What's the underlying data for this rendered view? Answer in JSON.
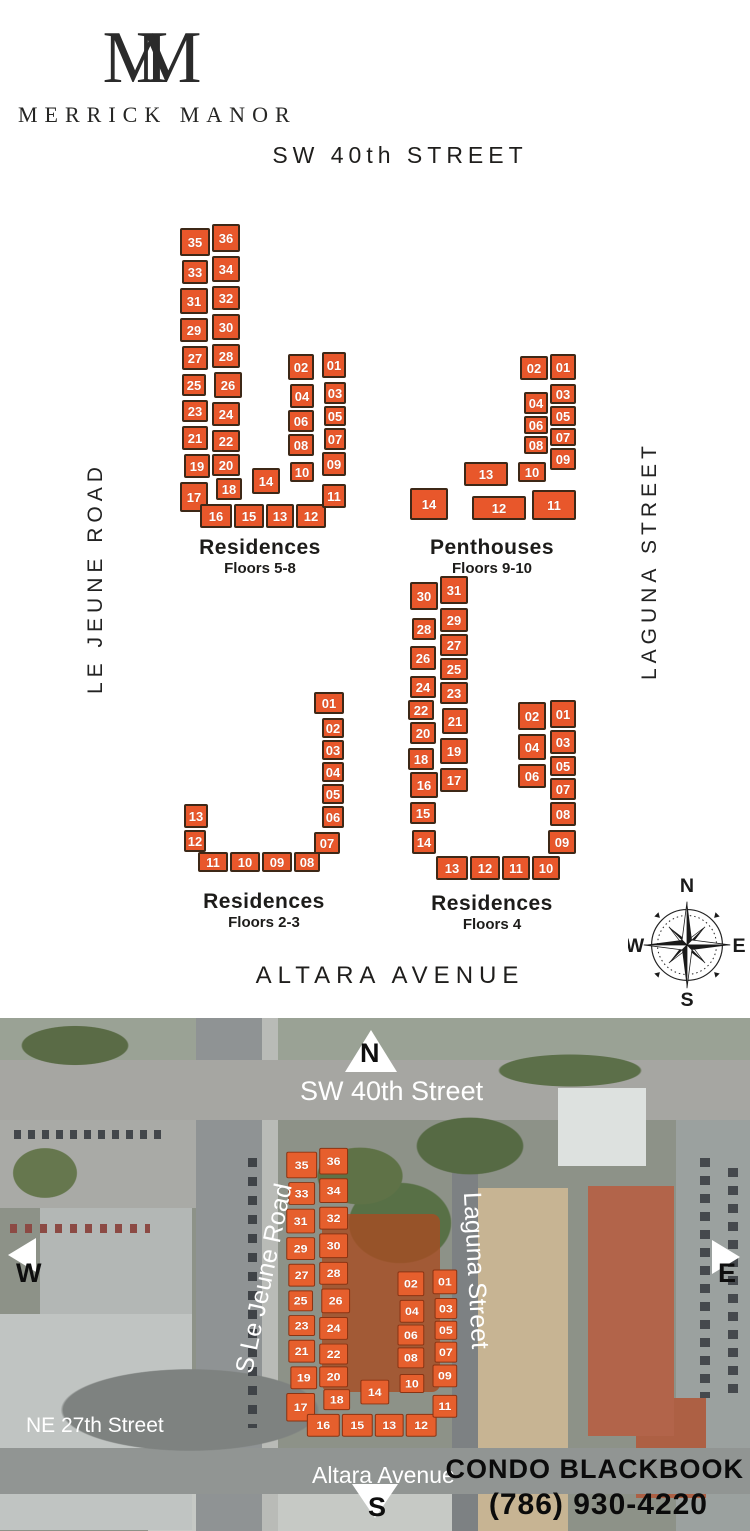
{
  "brand": {
    "monogram_left": "M",
    "monogram_right": "M",
    "name": "MERRICK MANOR"
  },
  "streets": {
    "top": "SW 40th STREET",
    "left": "LE JEUNE ROAD",
    "right": "LAGUNA STREET",
    "bottom": "ALTARA AVENUE"
  },
  "colors": {
    "unit": "#e8572b",
    "unit_border": "#3d2817",
    "overlay_unit": "#e65f2d"
  },
  "compass": {
    "n": "N",
    "e": "E",
    "s": "S",
    "w": "W"
  },
  "buildings": [
    {
      "id": "residences-5-8",
      "title": "Residences",
      "subtitle": "Floors 5-8",
      "pos": {
        "left": 172,
        "top": 222,
        "width": 176,
        "height": 308
      },
      "label_dy": 6,
      "units": [
        {
          "n": "35",
          "x": 8,
          "y": 6,
          "w": 30,
          "h": 28
        },
        {
          "n": "36",
          "x": 40,
          "y": 2,
          "w": 28,
          "h": 28
        },
        {
          "n": "33",
          "x": 10,
          "y": 38,
          "w": 26,
          "h": 24
        },
        {
          "n": "34",
          "x": 40,
          "y": 34,
          "w": 28,
          "h": 26
        },
        {
          "n": "31",
          "x": 8,
          "y": 66,
          "w": 28,
          "h": 26
        },
        {
          "n": "32",
          "x": 40,
          "y": 64,
          "w": 28,
          "h": 24
        },
        {
          "n": "29",
          "x": 8,
          "y": 96,
          "w": 28,
          "h": 24
        },
        {
          "n": "30",
          "x": 40,
          "y": 92,
          "w": 28,
          "h": 26
        },
        {
          "n": "27",
          "x": 10,
          "y": 124,
          "w": 26,
          "h": 24
        },
        {
          "n": "28",
          "x": 40,
          "y": 122,
          "w": 28,
          "h": 24
        },
        {
          "n": "25",
          "x": 10,
          "y": 152,
          "w": 24,
          "h": 22
        },
        {
          "n": "26",
          "x": 42,
          "y": 150,
          "w": 28,
          "h": 26
        },
        {
          "n": "23",
          "x": 10,
          "y": 178,
          "w": 26,
          "h": 22
        },
        {
          "n": "24",
          "x": 40,
          "y": 180,
          "w": 28,
          "h": 24
        },
        {
          "n": "21",
          "x": 10,
          "y": 204,
          "w": 26,
          "h": 24
        },
        {
          "n": "22",
          "x": 40,
          "y": 208,
          "w": 28,
          "h": 22
        },
        {
          "n": "19",
          "x": 12,
          "y": 232,
          "w": 26,
          "h": 24
        },
        {
          "n": "20",
          "x": 40,
          "y": 232,
          "w": 28,
          "h": 22
        },
        {
          "n": "17",
          "x": 8,
          "y": 260,
          "w": 28,
          "h": 30
        },
        {
          "n": "18",
          "x": 44,
          "y": 256,
          "w": 26,
          "h": 22
        },
        {
          "n": "14",
          "x": 80,
          "y": 246,
          "w": 28,
          "h": 26
        },
        {
          "n": "16",
          "x": 28,
          "y": 282,
          "w": 32,
          "h": 24
        },
        {
          "n": "15",
          "x": 62,
          "y": 282,
          "w": 30,
          "h": 24
        },
        {
          "n": "13",
          "x": 94,
          "y": 282,
          "w": 28,
          "h": 24
        },
        {
          "n": "12",
          "x": 124,
          "y": 282,
          "w": 30,
          "h": 24
        },
        {
          "n": "11",
          "x": 150,
          "y": 262,
          "w": 24,
          "h": 24
        },
        {
          "n": "10",
          "x": 118,
          "y": 240,
          "w": 24,
          "h": 20
        },
        {
          "n": "02",
          "x": 116,
          "y": 132,
          "w": 26,
          "h": 26
        },
        {
          "n": "01",
          "x": 150,
          "y": 130,
          "w": 24,
          "h": 26
        },
        {
          "n": "04",
          "x": 118,
          "y": 162,
          "w": 24,
          "h": 24
        },
        {
          "n": "03",
          "x": 152,
          "y": 160,
          "w": 22,
          "h": 22
        },
        {
          "n": "06",
          "x": 116,
          "y": 188,
          "w": 26,
          "h": 22
        },
        {
          "n": "05",
          "x": 152,
          "y": 184,
          "w": 22,
          "h": 20
        },
        {
          "n": "08",
          "x": 116,
          "y": 212,
          "w": 26,
          "h": 22
        },
        {
          "n": "07",
          "x": 152,
          "y": 206,
          "w": 22,
          "h": 22
        },
        {
          "n": "09",
          "x": 150,
          "y": 230,
          "w": 24,
          "h": 24
        }
      ]
    },
    {
      "id": "penthouses-9-10",
      "title": "Penthouses",
      "subtitle": "Floors 9-10",
      "pos": {
        "left": 406,
        "top": 350,
        "width": 172,
        "height": 178
      },
      "label_dy": 8,
      "units": [
        {
          "n": "02",
          "x": 114,
          "y": 6,
          "w": 28,
          "h": 24
        },
        {
          "n": "01",
          "x": 144,
          "y": 4,
          "w": 26,
          "h": 26
        },
        {
          "n": "04",
          "x": 118,
          "y": 42,
          "w": 24,
          "h": 22
        },
        {
          "n": "03",
          "x": 144,
          "y": 34,
          "w": 26,
          "h": 20
        },
        {
          "n": "06",
          "x": 118,
          "y": 66,
          "w": 24,
          "h": 18
        },
        {
          "n": "05",
          "x": 144,
          "y": 56,
          "w": 26,
          "h": 20
        },
        {
          "n": "08",
          "x": 118,
          "y": 86,
          "w": 24,
          "h": 18
        },
        {
          "n": "07",
          "x": 144,
          "y": 78,
          "w": 26,
          "h": 18
        },
        {
          "n": "10",
          "x": 112,
          "y": 112,
          "w": 28,
          "h": 20
        },
        {
          "n": "09",
          "x": 144,
          "y": 98,
          "w": 26,
          "h": 22
        },
        {
          "n": "13",
          "x": 58,
          "y": 112,
          "w": 44,
          "h": 24
        },
        {
          "n": "14",
          "x": 4,
          "y": 138,
          "w": 38,
          "h": 32
        },
        {
          "n": "12",
          "x": 66,
          "y": 146,
          "w": 54,
          "h": 24
        },
        {
          "n": "11",
          "x": 126,
          "y": 140,
          "w": 44,
          "h": 30
        }
      ]
    },
    {
      "id": "residences-2-3",
      "title": "Residences",
      "subtitle": "Floors 2-3",
      "pos": {
        "left": 182,
        "top": 690,
        "width": 164,
        "height": 184
      },
      "label_dy": 16,
      "units": [
        {
          "n": "01",
          "x": 132,
          "y": 2,
          "w": 30,
          "h": 22
        },
        {
          "n": "02",
          "x": 140,
          "y": 28,
          "w": 22,
          "h": 20
        },
        {
          "n": "03",
          "x": 140,
          "y": 50,
          "w": 22,
          "h": 20
        },
        {
          "n": "04",
          "x": 140,
          "y": 72,
          "w": 22,
          "h": 20
        },
        {
          "n": "05",
          "x": 140,
          "y": 94,
          "w": 22,
          "h": 20
        },
        {
          "n": "06",
          "x": 140,
          "y": 116,
          "w": 22,
          "h": 22
        },
        {
          "n": "07",
          "x": 132,
          "y": 142,
          "w": 26,
          "h": 22
        },
        {
          "n": "08",
          "x": 112,
          "y": 162,
          "w": 26,
          "h": 20
        },
        {
          "n": "09",
          "x": 80,
          "y": 162,
          "w": 30,
          "h": 20
        },
        {
          "n": "10",
          "x": 48,
          "y": 162,
          "w": 30,
          "h": 20
        },
        {
          "n": "11",
          "x": 16,
          "y": 162,
          "w": 30,
          "h": 20
        },
        {
          "n": "12",
          "x": 2,
          "y": 140,
          "w": 22,
          "h": 22
        },
        {
          "n": "13",
          "x": 2,
          "y": 114,
          "w": 24,
          "h": 24
        }
      ]
    },
    {
      "id": "residences-4",
      "title": "Residences",
      "subtitle": "Floors 4",
      "pos": {
        "left": 406,
        "top": 572,
        "width": 172,
        "height": 310
      },
      "label_dy": 10,
      "units": [
        {
          "n": "30",
          "x": 4,
          "y": 10,
          "w": 28,
          "h": 28
        },
        {
          "n": "31",
          "x": 34,
          "y": 4,
          "w": 28,
          "h": 28
        },
        {
          "n": "28",
          "x": 6,
          "y": 46,
          "w": 24,
          "h": 22
        },
        {
          "n": "29",
          "x": 34,
          "y": 36,
          "w": 28,
          "h": 24
        },
        {
          "n": "26",
          "x": 4,
          "y": 74,
          "w": 26,
          "h": 24
        },
        {
          "n": "27",
          "x": 34,
          "y": 62,
          "w": 28,
          "h": 22
        },
        {
          "n": "24",
          "x": 4,
          "y": 104,
          "w": 26,
          "h": 22
        },
        {
          "n": "25",
          "x": 34,
          "y": 86,
          "w": 28,
          "h": 22
        },
        {
          "n": "22",
          "x": 2,
          "y": 128,
          "w": 26,
          "h": 20
        },
        {
          "n": "23",
          "x": 34,
          "y": 110,
          "w": 28,
          "h": 22
        },
        {
          "n": "20",
          "x": 4,
          "y": 150,
          "w": 26,
          "h": 22
        },
        {
          "n": "21",
          "x": 36,
          "y": 136,
          "w": 26,
          "h": 26
        },
        {
          "n": "18",
          "x": 2,
          "y": 176,
          "w": 26,
          "h": 22
        },
        {
          "n": "19",
          "x": 34,
          "y": 166,
          "w": 28,
          "h": 26
        },
        {
          "n": "16",
          "x": 4,
          "y": 200,
          "w": 28,
          "h": 26
        },
        {
          "n": "17",
          "x": 34,
          "y": 196,
          "w": 28,
          "h": 24
        },
        {
          "n": "15",
          "x": 4,
          "y": 230,
          "w": 26,
          "h": 22
        },
        {
          "n": "14",
          "x": 6,
          "y": 258,
          "w": 24,
          "h": 24
        },
        {
          "n": "13",
          "x": 30,
          "y": 284,
          "w": 32,
          "h": 24
        },
        {
          "n": "12",
          "x": 64,
          "y": 284,
          "w": 30,
          "h": 24
        },
        {
          "n": "11",
          "x": 96,
          "y": 284,
          "w": 28,
          "h": 24
        },
        {
          "n": "10",
          "x": 126,
          "y": 284,
          "w": 28,
          "h": 24
        },
        {
          "n": "09",
          "x": 142,
          "y": 258,
          "w": 28,
          "h": 24
        },
        {
          "n": "08",
          "x": 144,
          "y": 230,
          "w": 26,
          "h": 24
        },
        {
          "n": "07",
          "x": 144,
          "y": 206,
          "w": 26,
          "h": 22
        },
        {
          "n": "05",
          "x": 144,
          "y": 184,
          "w": 26,
          "h": 20
        },
        {
          "n": "03",
          "x": 144,
          "y": 158,
          "w": 26,
          "h": 24
        },
        {
          "n": "01",
          "x": 144,
          "y": 128,
          "w": 26,
          "h": 28
        },
        {
          "n": "02",
          "x": 112,
          "y": 130,
          "w": 28,
          "h": 28
        },
        {
          "n": "04",
          "x": 112,
          "y": 162,
          "w": 28,
          "h": 26
        },
        {
          "n": "06",
          "x": 112,
          "y": 192,
          "w": 28,
          "h": 24
        }
      ]
    }
  ],
  "aerial": {
    "footprint_building": "residences-5-8",
    "north_label": "N",
    "sw40": "SW 40th Street",
    "lejeune": "S Le Jeune Road",
    "laguna": "Laguna Street",
    "west": "W",
    "east": "E",
    "south": "S",
    "ne27": "NE 27th Street",
    "altara": "Altara Avenue",
    "brand_line1": "CONDO BLACKBOOK",
    "brand_line2": "(786) 930-4220"
  }
}
